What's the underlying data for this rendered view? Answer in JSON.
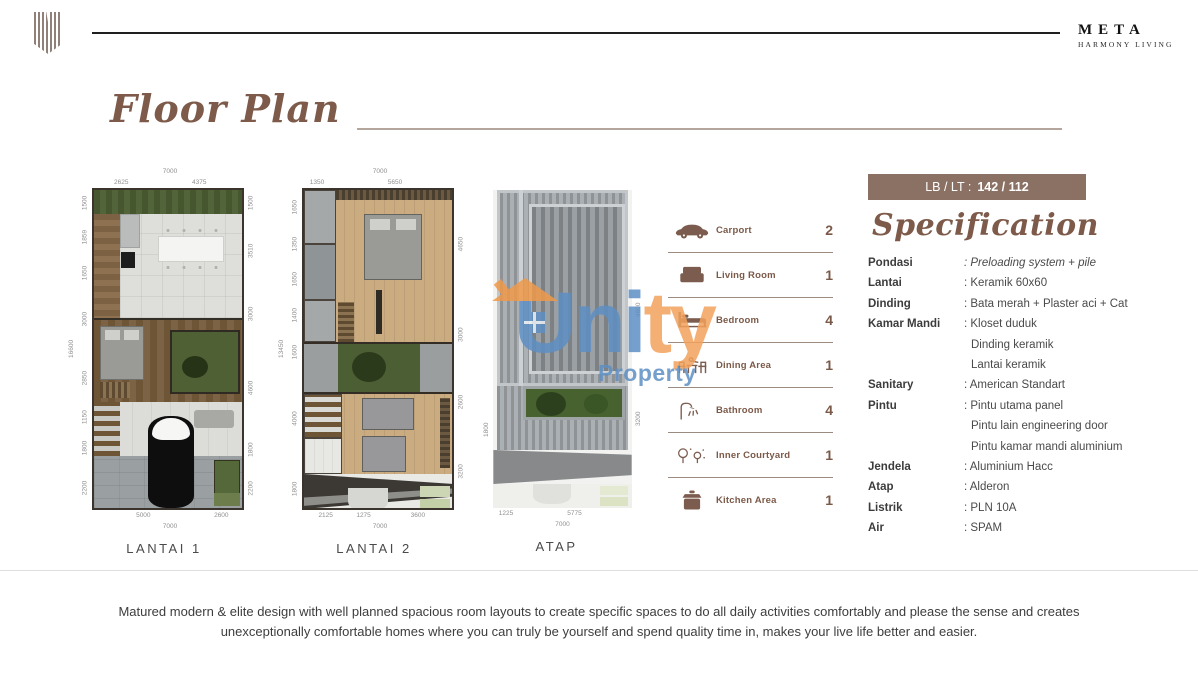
{
  "brand": {
    "logo": "meta-monogram",
    "name_top": "META",
    "name_bottom": "HARMONY LIVING"
  },
  "title": "Floor Plan",
  "floors": [
    {
      "label": "LANTAI 1",
      "dims_top": [
        "7000",
        "2625",
        "4375"
      ],
      "dims_bottom": [
        "5000",
        "2600",
        "7000"
      ],
      "dims_left": [
        "1500",
        "1859",
        "1650",
        "3000",
        "2850",
        "1150",
        "1800",
        "2200"
      ],
      "dim_left_overall": "16600",
      "dims_right": [
        "1500",
        "3510",
        "3000",
        "4600",
        "1800",
        "2200"
      ]
    },
    {
      "label": "LANTAI 2",
      "dims_top": [
        "7000",
        "1350",
        "5650"
      ],
      "dims_bottom": [
        "2125",
        "1275",
        "3600",
        "7000"
      ],
      "dims_left": [
        "1650",
        "1350",
        "1650",
        "1400",
        "1600",
        "4000",
        "1800"
      ],
      "dim_left_overall": "13450",
      "dims_right": [
        "4650",
        "3000",
        "2600",
        "3200"
      ]
    },
    {
      "label": "ATAP",
      "dims_bottom": [
        "1225",
        "5775",
        "7000"
      ],
      "dims_left": [
        "1800"
      ],
      "dims_right": [
        "4600",
        "3200"
      ]
    }
  ],
  "legend": {
    "items": [
      {
        "icon": "car-icon",
        "label": "Carport",
        "count": "2"
      },
      {
        "icon": "sofa-icon",
        "label": "Living Room",
        "count": "1"
      },
      {
        "icon": "bed-icon",
        "label": "Bedroom",
        "count": "4"
      },
      {
        "icon": "dining-icon",
        "label": "Dining Area",
        "count": "1"
      },
      {
        "icon": "shower-icon",
        "label": "Bathroom",
        "count": "4"
      },
      {
        "icon": "courtyard-icon",
        "label": "Inner Courtyard",
        "count": "1"
      },
      {
        "icon": "pot-icon",
        "label": "Kitchen Area",
        "count": "1"
      }
    ]
  },
  "spec": {
    "badge": {
      "prefix": "LB / LT :",
      "value": "142 / 112"
    },
    "heading": "Specification",
    "rows": [
      {
        "label": "Pondasi",
        "values": [
          ": Preloading system + pile"
        ],
        "italic": true
      },
      {
        "label": "Lantai",
        "values": [
          ": Keramik 60x60"
        ]
      },
      {
        "label": "Dinding",
        "values": [
          ": Bata merah + Plaster aci + Cat"
        ]
      },
      {
        "label": "Kamar Mandi",
        "values": [
          ": Kloset duduk",
          "Dinding keramik",
          "Lantai keramik"
        ]
      },
      {
        "label": "Sanitary",
        "values": [
          ": American Standart"
        ]
      },
      {
        "label": "Pintu",
        "values": [
          ": Pintu utama panel",
          "Pintu lain engineering door",
          "Pintu kamar mandi aluminium"
        ]
      },
      {
        "label": "Jendela",
        "values": [
          ": Aluminium Hacc"
        ]
      },
      {
        "label": "Atap",
        "values": [
          ": Alderon"
        ]
      },
      {
        "label": "Listrik",
        "values": [
          ": PLN 10A"
        ]
      },
      {
        "label": "Air",
        "values": [
          ": SPAM"
        ]
      }
    ]
  },
  "watermark": {
    "brand_blue": "Uni",
    "brand_orange": "ty",
    "label": "Property"
  },
  "footer": {
    "line1": "Matured modern & elite design with well planned spacious room layouts to create specific spaces to do all daily activities comfortably and please the sense and creates",
    "line2": "unexceptionally comfortable homes where you can truly be yourself and spend quality time in, makes your live life better and easier."
  },
  "colors": {
    "accent-brown": "#7d5a49",
    "badge-bg": "#8a7164",
    "legend-brown": "#7b5948",
    "watermark-blue": "#5e8fc4",
    "watermark-orange": "#f2a25c",
    "header-ink": "#1f1f1f"
  }
}
